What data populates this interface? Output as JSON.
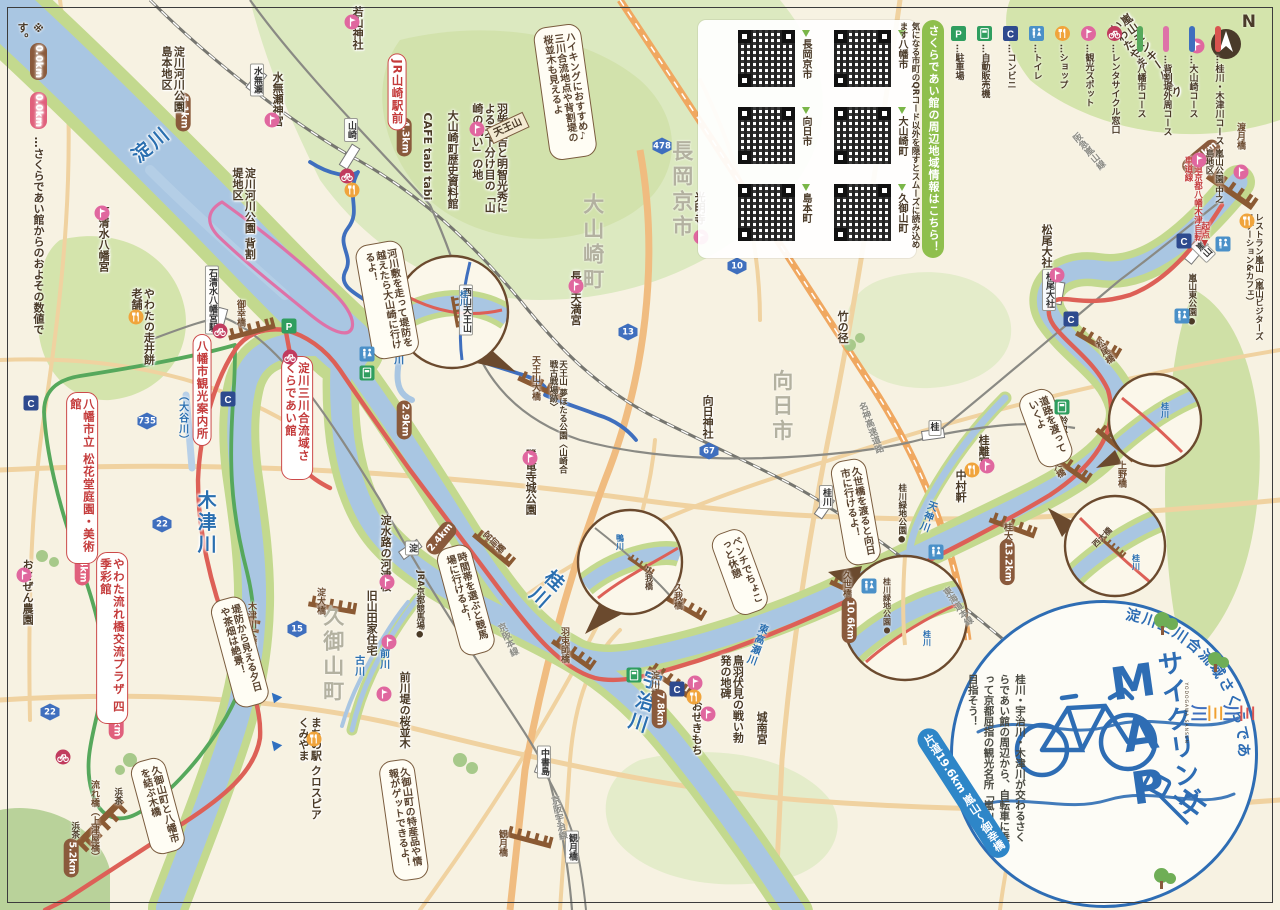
{
  "note": {
    "prefix": "※",
    "badge_brown": "0.0km",
    "badge_pink": "0.0km",
    "text": "…さくらであい館からのおよその数値です。"
  },
  "compass": {
    "n": "N"
  },
  "legend": {
    "items": [
      {
        "type": "parking",
        "label": "…駐車場"
      },
      {
        "type": "vending",
        "label": "…自動販売機"
      },
      {
        "type": "conbini",
        "label": "…コンビニ"
      },
      {
        "type": "toilet",
        "label": "…トイレ"
      },
      {
        "type": "shop",
        "label": "…ショップ"
      },
      {
        "type": "spot",
        "label": "…観光スポット"
      },
      {
        "type": "rental",
        "label": "…レンタサイクル窓口"
      },
      {
        "type": "course",
        "color": "#56a85c",
        "label": "…八幡市コース"
      },
      {
        "type": "course",
        "color": "#de72a8",
        "label": "…背割堤外周コース"
      },
      {
        "type": "course",
        "color": "#3f6fbe",
        "label": "…大山崎コース"
      },
      {
        "type": "course",
        "color": "#d9534f",
        "label": "…桂川・木津川コース"
      }
    ]
  },
  "qr_panel": {
    "banner": "さくらであい館の周辺地域情報はこちら！",
    "note": "気になる市町のQRコード以外を隠すとスムーズに読み込めます",
    "items": [
      "八幡市",
      "長岡京市",
      "大山崎町",
      "向日市",
      "久御山町",
      "島本町"
    ]
  },
  "stamp": {
    "arc": "淀川三川合流域さくらであい館",
    "title_kana": "サイクリング",
    "title_latin": "MAP",
    "desc": "桂川・宇治川・木津川が交わるさくらであい館の周辺から、自転車に乗って京都屈指の観光名所「嵐山」を目指そう！",
    "distance": "片道19.6km",
    "route": "嵐山〜御幸橋",
    "logo_chars": [
      {
        "ch": "三",
        "color": "#d9534f"
      },
      {
        "ch": "川",
        "color": "#3f6fbe"
      },
      {
        "ch": "三",
        "color": "#f0a030"
      },
      {
        "ch": "川",
        "color": "#3f6fbe"
      }
    ],
    "logo_caption": "YODOGAWA SANSEN"
  },
  "labels": [
    {
      "t": "淀川",
      "x": 152,
      "y": 145,
      "c": "riv",
      "r": -40,
      "n": "river-yodogawa"
    },
    {
      "t": "桂川",
      "x": 545,
      "y": 588,
      "c": "riv v",
      "r": 42,
      "n": "river-katsuragawa"
    },
    {
      "t": "木津川",
      "x": 205,
      "y": 523,
      "c": "riv v",
      "n": "river-kizugawa"
    },
    {
      "t": "宇治川",
      "x": 643,
      "y": 702,
      "c": "riv v",
      "r": 18,
      "n": "river-ujigawa"
    },
    {
      "t": "天神川",
      "x": 927,
      "y": 516,
      "c": "rivs v",
      "r": 20,
      "n": "river-tenjingawa"
    },
    {
      "t": "小泉川",
      "x": 397,
      "y": 349,
      "c": "rivs v",
      "n": "river-koizumigawa"
    },
    {
      "t": "前川",
      "x": 383,
      "y": 659,
      "c": "rivs v",
      "n": "river-maekawa"
    },
    {
      "t": "古川",
      "x": 358,
      "y": 666,
      "c": "rivs v",
      "n": "river-furukawa"
    },
    {
      "t": "（大谷川）",
      "x": 182,
      "y": 418,
      "c": "rivs v",
      "n": "river-otanigawa"
    },
    {
      "t": "東高瀬川",
      "x": 756,
      "y": 644,
      "c": "rivs v",
      "r": 20,
      "n": "river-higashitakase"
    },
    {
      "t": "八幡市",
      "x": 76,
      "y": 482,
      "c": "area v",
      "n": "area-yawata-city"
    },
    {
      "t": "久御山町",
      "x": 332,
      "y": 655,
      "c": "area v",
      "n": "area-kumiyama"
    },
    {
      "t": "大山崎町",
      "x": 592,
      "y": 243,
      "c": "area v",
      "n": "area-oyamazaki"
    },
    {
      "t": "長岡京市",
      "x": 681,
      "y": 190,
      "c": "area v",
      "n": "area-nagaokakyo"
    },
    {
      "t": "向日市",
      "x": 781,
      "y": 407,
      "c": "area v",
      "n": "area-muko"
    },
    {
      "t": "水無瀬",
      "x": 257,
      "y": 80,
      "c": "sta v",
      "n": "station-minase"
    },
    {
      "t": "山崎",
      "x": 351,
      "y": 130,
      "c": "sta v",
      "n": "station-yamazaki"
    },
    {
      "t": "石清水八幡宮駅",
      "x": 212,
      "y": 300,
      "c": "sta v",
      "n": "station-iwashimizu"
    },
    {
      "t": "淀",
      "x": 412,
      "y": 548,
      "c": "sta v",
      "n": "station-yodo"
    },
    {
      "t": "中書島",
      "x": 544,
      "y": 762,
      "c": "sta v",
      "n": "station-chushojima"
    },
    {
      "t": "観月橋",
      "x": 572,
      "y": 847,
      "c": "sta v",
      "n": "station-kangetsukyo"
    },
    {
      "t": "桂",
      "x": 935,
      "y": 428,
      "c": "sta",
      "n": "station-katsura"
    },
    {
      "t": "桂川",
      "x": 826,
      "y": 497,
      "c": "sta v",
      "n": "station-katsuragawa"
    },
    {
      "t": "嵐山",
      "x": 1203,
      "y": 250,
      "c": "sta v",
      "r": -45,
      "n": "station-arashiyama"
    },
    {
      "t": "松尾大社",
      "x": 1049,
      "y": 290,
      "c": "sta v",
      "n": "station-matsuo-taisha"
    },
    {
      "t": "西山天王山",
      "x": 466,
      "y": 310,
      "c": "sta v",
      "n": "station-nishiyama-tennozan"
    },
    {
      "t": "京阪本線",
      "x": 507,
      "y": 640,
      "c": "rail v",
      "r": -25,
      "n": "railline-keihan-main"
    },
    {
      "t": "京阪宇治線",
      "x": 558,
      "y": 818,
      "c": "rail v",
      "r": -12,
      "n": "railline-keihan-uji"
    },
    {
      "t": "東海道本線",
      "x": 957,
      "y": 607,
      "c": "rail v",
      "r": -35,
      "n": "railline-tokaido"
    },
    {
      "t": "阪急嵐山線",
      "x": 1088,
      "y": 152,
      "c": "rail v",
      "r": -40,
      "n": "railline-hankyu-arashiyama"
    },
    {
      "t": "名神高速道路",
      "x": 870,
      "y": 428,
      "c": "rail v",
      "r": -20,
      "n": "road-meishin"
    },
    {
      "t": "御幸橋",
      "x": 240,
      "y": 313,
      "c": "brg v",
      "n": "bridge-gokobashi"
    },
    {
      "t": "天王山大橋",
      "x": 535,
      "y": 378,
      "c": "brg v",
      "n": "bridge-tennozan"
    },
    {
      "t": "宮前橋",
      "x": 493,
      "y": 543,
      "c": "brg v",
      "r": -45,
      "n": "bridge-miyamae"
    },
    {
      "t": "羽束師橋",
      "x": 564,
      "y": 645,
      "c": "brg v",
      "n": "bridge-hazukashi"
    },
    {
      "t": "久我橋",
      "x": 677,
      "y": 596,
      "c": "brg v",
      "n": "bridge-kugabashi"
    },
    {
      "t": "久世橋",
      "x": 846,
      "y": 584,
      "c": "brg v",
      "n": "bridge-kuzebashi"
    },
    {
      "t": "桂大橋",
      "x": 1007,
      "y": 536,
      "c": "brg v",
      "n": "bridge-katsura-ohashi"
    },
    {
      "t": "西大橋",
      "x": 1055,
      "y": 466,
      "c": "brg v",
      "r": -30,
      "n": "bridge-nishi-ohashi"
    },
    {
      "t": "上野橋",
      "x": 1121,
      "y": 474,
      "c": "brg v",
      "n": "bridge-uenobashi"
    },
    {
      "t": "松尾橋",
      "x": 1104,
      "y": 352,
      "c": "brg v",
      "r": -30,
      "n": "bridge-matsuobashi"
    },
    {
      "t": "渡月橋",
      "x": 1240,
      "y": 136,
      "c": "brg v",
      "n": "bridge-togetsukyo"
    },
    {
      "t": "淀大橋",
      "x": 320,
      "y": 601,
      "c": "brg v",
      "n": "bridge-yodo-ohashi"
    },
    {
      "t": "木津川大橋",
      "x": 251,
      "y": 624,
      "c": "brg v",
      "n": "bridge-kizugawa-ohashi"
    },
    {
      "t": "淀川橋",
      "x": 654,
      "y": 684,
      "c": "brg v",
      "n": "bridge-yodogawabashi"
    },
    {
      "t": "観月橋",
      "x": 502,
      "y": 843,
      "c": "brg v",
      "n": "bridge-kangetsukyo"
    },
    {
      "t": "流れ橋（上津屋橋）",
      "x": 94,
      "y": 834,
      "c": "brg v",
      "h": 108,
      "n": "bridge-nagarebashi"
    },
    {
      "t": "19.6km",
      "x": 1201,
      "y": 157,
      "c": "bb",
      "r": -40,
      "n": "distance-togetsukyo"
    },
    {
      "t": "4.3km",
      "x": 404,
      "y": 137,
      "c": "bb v",
      "n": "distance-yamazaki"
    },
    {
      "t": "5.1km",
      "x": 183,
      "y": 112,
      "c": "bb v",
      "n": "distance-shimamoto"
    },
    {
      "t": "2.9km",
      "x": 404,
      "y": 420,
      "c": "bb v",
      "n": "distance-29"
    },
    {
      "t": "2.4km",
      "x": 441,
      "y": 538,
      "c": "bb",
      "r": -50,
      "n": "distance-miyamae"
    },
    {
      "t": "13.2km",
      "x": 1007,
      "y": 562,
      "c": "bb v",
      "n": "distance-katsura-ohashi"
    },
    {
      "t": "10.6km",
      "x": 849,
      "y": 620,
      "c": "bb v",
      "n": "distance-kuzebashi"
    },
    {
      "t": "7.8km",
      "x": 659,
      "y": 709,
      "c": "bb v",
      "n": "distance-yodogawabashi"
    },
    {
      "t": "5.2km",
      "x": 71,
      "y": 858,
      "c": "bb v",
      "n": "distance-nagarebashi"
    },
    {
      "t": "3.4km",
      "x": 82,
      "y": 566,
      "c": "bp v",
      "n": "distance-shokado"
    },
    {
      "t": "7.8km",
      "x": 116,
      "y": 720,
      "c": "bp v",
      "n": "distance-shikisaikan"
    },
    {
      "t": "JR山崎駅前",
      "x": 397,
      "y": 92,
      "c": "pill v",
      "n": "poi-jr-yamazaki-ekimae"
    },
    {
      "t": "八幡市観光案内所",
      "x": 202,
      "y": 390,
      "c": "pill v",
      "n": "poi-yawata-tourist-info"
    },
    {
      "t": "淀川三川合流域さくらであい館",
      "x": 297,
      "y": 418,
      "c": "pill v",
      "h": 112,
      "n": "poi-sakura-deaikan"
    },
    {
      "t": "八幡市立 松花堂庭園・美術館",
      "x": 82,
      "y": 478,
      "c": "pill v",
      "h": 160,
      "n": "poi-shokado-garden"
    },
    {
      "t": "やわた流れ橋交流プラザ 四季彩館",
      "x": 112,
      "y": 638,
      "c": "pill v",
      "h": 160,
      "n": "poi-shikisaikan"
    },
    {
      "t": "嵐山モンキーパーク いわたやま",
      "x": 1146,
      "y": 60,
      "c": "poi v",
      "h": 100,
      "r": -35,
      "n": "poi-monkey-park"
    },
    {
      "t": "嵐山公園 中之島地区",
      "x": 1213,
      "y": 180,
      "c": "pois v",
      "h": 62,
      "n": "poi-arashiyama-park"
    },
    {
      "t": "レストラン嵐山（嵐山ビジターズステーション&カフェ）",
      "x": 1253,
      "y": 278,
      "c": "pois v",
      "h": 130,
      "n": "poi-restaurant-arashiyama"
    },
    {
      "t": "嵐山東公園●",
      "x": 1191,
      "y": 300,
      "c": "pois v",
      "n": "poi-arashiyama-higashi-park"
    },
    {
      "t": "松尾大社",
      "x": 1046,
      "y": 246,
      "c": "poi v",
      "n": "poi-matsuo-taisha"
    },
    {
      "t": "●鈴虫寺",
      "x": 1062,
      "y": 424,
      "c": "pois v",
      "n": "poi-suzumushidera"
    },
    {
      "t": "桂離宮",
      "x": 983,
      "y": 451,
      "c": "poi v",
      "n": "poi-katsura-rikyu"
    },
    {
      "t": "中村軒",
      "x": 960,
      "y": 486,
      "c": "poi v",
      "n": "poi-nakamuraken"
    },
    {
      "t": "桂川緑地公園●",
      "x": 901,
      "y": 514,
      "c": "pois v",
      "n": "poi-katsuragawa-ryokuchi"
    },
    {
      "t": "竹の径",
      "x": 842,
      "y": 327,
      "c": "poi v",
      "n": "poi-takenomichi"
    },
    {
      "t": "向日神社",
      "x": 707,
      "y": 417,
      "c": "poi v",
      "n": "poi-muko-jinja"
    },
    {
      "t": "長岡天満宮",
      "x": 575,
      "y": 298,
      "c": "poi v",
      "n": "poi-nagaoka-tenmangu"
    },
    {
      "t": "光明寺",
      "x": 699,
      "y": 208,
      "c": "poi v",
      "n": "poi-komyoji"
    },
    {
      "t": "勝竜寺城公園",
      "x": 530,
      "y": 482,
      "c": "poi v",
      "n": "poi-shoryuji-castle-park"
    },
    {
      "t": "天王山 夢ほたる公園〈山崎合戦古戦場跡〉",
      "x": 557,
      "y": 420,
      "c": "pois v",
      "h": 120,
      "n": "poi-yumehotaru-park"
    },
    {
      "t": "大山崎町歴史資料館",
      "x": 452,
      "y": 170,
      "c": "poi v",
      "h": 120,
      "n": "poi-oyamazaki-museum"
    },
    {
      "t": "CAFE tabi tabi",
      "x": 427,
      "y": 160,
      "c": "poi v",
      "h": 95,
      "n": "poi-cafe-tabitabi"
    },
    {
      "t": "羽柴秀吉と明智光秀による天下分け目の「山崎の戦い」の地",
      "x": 489,
      "y": 158,
      "c": "poi v",
      "h": 110,
      "n": "poi-yamazaki-battle-site"
    },
    {
      "t": "天王山",
      "x": 508,
      "y": 128,
      "c": "sign",
      "r": -25,
      "n": "poi-tennozan-sign"
    },
    {
      "t": "若山神社",
      "x": 357,
      "y": 36,
      "c": "poi v",
      "h": 60,
      "n": "poi-wakayama-jinja"
    },
    {
      "t": "水無瀬神宮",
      "x": 277,
      "y": 99,
      "c": "poi v",
      "n": "poi-minase-jingu"
    },
    {
      "t": "淀川河川公園 背割堤地区",
      "x": 243,
      "y": 215,
      "c": "poi v",
      "h": 95,
      "n": "poi-sewaritei-area"
    },
    {
      "t": "淀川河川公園 島本地区",
      "x": 172,
      "y": 86,
      "c": "poi v",
      "h": 80,
      "n": "poi-shimamoto-area"
    },
    {
      "t": "石清水八幡宮",
      "x": 103,
      "y": 239,
      "c": "poi v",
      "n": "poi-iwashimizu-hachimangu"
    },
    {
      "t": "やわたの走井餅老舗",
      "x": 142,
      "y": 328,
      "c": "poi v",
      "h": 80,
      "n": "poi-hashiirimochi"
    },
    {
      "t": "おさぜん農園",
      "x": 27,
      "y": 592,
      "c": "poi v",
      "n": "poi-osazen-farm"
    },
    {
      "t": "浜茶",
      "x": 117,
      "y": 796,
      "c": "pois v",
      "n": "poi-hamacha-1"
    },
    {
      "t": "浜茶",
      "x": 74,
      "y": 830,
      "c": "pois v",
      "n": "poi-hamacha-2"
    },
    {
      "t": "JRA京都競馬場●",
      "x": 419,
      "y": 605,
      "c": "pois v",
      "n": "poi-kyoto-racecourse"
    },
    {
      "t": "淀水路の河津桜",
      "x": 385,
      "y": 553,
      "c": "poi v",
      "n": "poi-yodo-suiro-sakura"
    },
    {
      "t": "旧山田家住宅",
      "x": 371,
      "y": 623,
      "c": "poi v",
      "n": "poi-yamada-house"
    },
    {
      "t": "前川堤の桜並木",
      "x": 404,
      "y": 710,
      "c": "poi v",
      "n": "poi-maekawa-sakura"
    },
    {
      "t": "まちの駅 クロスピアくみやま",
      "x": 309,
      "y": 772,
      "c": "poi v",
      "h": 110,
      "n": "poi-crosspia-kumiyama"
    },
    {
      "t": "鳥羽伏見の戦い勃発の地碑",
      "x": 731,
      "y": 700,
      "c": "poi v",
      "h": 90,
      "n": "poi-toba-fushimi-monument"
    },
    {
      "t": "城南宮",
      "x": 761,
      "y": 728,
      "c": "poi v",
      "n": "poi-jonangu"
    },
    {
      "t": "おせきもち",
      "x": 696,
      "y": 728,
      "c": "poi v",
      "n": "poi-osekimochi"
    },
    {
      "t": "府道京都八幡木津自転車道線",
      "x": 1192,
      "y": 202,
      "c": "reds v",
      "h": 92,
      "n": "label-cycling-road"
    },
    {
      "t": "起点▼",
      "x": 1204,
      "y": 235,
      "c": "reds v",
      "n": "label-kiten"
    },
    {
      "t": "ハイキングにおすすめ♪ 三川合流地点や背割堤の桜並木も見えるよ",
      "x": 565,
      "y": 92,
      "c": "bub v",
      "h": 118,
      "r": -8,
      "n": "bubble-hiking"
    },
    {
      "t": "河川敷を走って堤防を越えたら大山崎に行けるよ！",
      "x": 387,
      "y": 300,
      "c": "bub v",
      "h": 100,
      "r": -10,
      "n": "bubble-kasenjiki"
    },
    {
      "t": "時間帯を選ぶと競馬場に行けるよ！",
      "x": 466,
      "y": 600,
      "c": "bub v",
      "h": 95,
      "r": -15,
      "n": "bubble-racecourse"
    },
    {
      "t": "ベンチでちょこっと休憩",
      "x": 740,
      "y": 572,
      "c": "bub v",
      "h": 70,
      "r": -20,
      "n": "bubble-bench"
    },
    {
      "t": "久世橋を渡ると向日市に行けるよ！",
      "x": 856,
      "y": 512,
      "c": "bub v",
      "h": 90,
      "r": -10,
      "n": "bubble-kuzebashi"
    },
    {
      "t": "堤防から見える夕日や茶畑は絶景！",
      "x": 240,
      "y": 652,
      "c": "bub v",
      "h": 95,
      "r": -15,
      "n": "bubble-chabatake"
    },
    {
      "t": "久御山町と八幡市を結ぶ木橋",
      "x": 158,
      "y": 806,
      "c": "bub v",
      "h": 80,
      "r": -15,
      "n": "bubble-wooden-bridge"
    },
    {
      "t": "久御山町の特産品や情報がゲットできるよ！",
      "x": 404,
      "y": 820,
      "c": "bub v",
      "h": 105,
      "r": -8,
      "n": "bubble-kumiyama-info"
    },
    {
      "t": "道路を渡っていくよ",
      "x": 1046,
      "y": 428,
      "c": "bub v",
      "h": 62,
      "r": -20,
      "n": "bubble-cross-road"
    },
    {
      "t": "桂川",
      "x": 463,
      "y": 298,
      "c": "ins v",
      "n": "inset-a-katsuragawa"
    },
    {
      "t": "鴨川",
      "x": 619,
      "y": 542,
      "c": "ins v",
      "n": "inset-b-kamogawa"
    },
    {
      "t": "久我橋",
      "x": 648,
      "y": 578,
      "c": "insb v",
      "n": "inset-b-kugabashi"
    },
    {
      "t": "桂川緑地公園●",
      "x": 886,
      "y": 606,
      "c": "insb v",
      "n": "inset-c-ryokuchi"
    },
    {
      "t": "桂川",
      "x": 926,
      "y": 638,
      "c": "ins v",
      "n": "inset-c-katsuragawa"
    },
    {
      "t": "桂川",
      "x": 1164,
      "y": 410,
      "c": "ins v",
      "n": "inset-d-katsuragawa"
    },
    {
      "t": "西大橋",
      "x": 1103,
      "y": 538,
      "c": "insb",
      "r": -45,
      "n": "inset-e-nishiohashi"
    },
    {
      "t": "桂川",
      "x": 1135,
      "y": 562,
      "c": "ins v",
      "n": "inset-e-katsuragawa"
    }
  ],
  "shields": [
    {
      "no": "478",
      "x": 662,
      "y": 146
    },
    {
      "no": "10",
      "x": 737,
      "y": 266
    },
    {
      "no": "13",
      "x": 628,
      "y": 332
    },
    {
      "no": "67",
      "x": 709,
      "y": 451
    },
    {
      "no": "735",
      "x": 147,
      "y": 421
    },
    {
      "no": "22",
      "x": 162,
      "y": 524
    },
    {
      "no": "22",
      "x": 50,
      "y": 712
    },
    {
      "no": "15",
      "x": 297,
      "y": 629
    }
  ],
  "markers": [
    {
      "k": "rental",
      "x": 290,
      "y": 357
    },
    {
      "k": "rental",
      "x": 220,
      "y": 331
    },
    {
      "k": "rental",
      "x": 347,
      "y": 176
    },
    {
      "k": "rental",
      "x": 63,
      "y": 757
    },
    {
      "k": "spot",
      "x": 352,
      "y": 22
    },
    {
      "k": "spot",
      "x": 272,
      "y": 120
    },
    {
      "k": "spot",
      "x": 102,
      "y": 213
    },
    {
      "k": "spot",
      "x": 477,
      "y": 129
    },
    {
      "k": "spot",
      "x": 701,
      "y": 237
    },
    {
      "k": "spot",
      "x": 576,
      "y": 286
    },
    {
      "k": "spot",
      "x": 530,
      "y": 458
    },
    {
      "k": "spot",
      "x": 1057,
      "y": 275
    },
    {
      "k": "spot",
      "x": 987,
      "y": 466
    },
    {
      "k": "spot",
      "x": 387,
      "y": 582
    },
    {
      "k": "spot",
      "x": 389,
      "y": 642
    },
    {
      "k": "spot",
      "x": 384,
      "y": 694
    },
    {
      "k": "spot",
      "x": 695,
      "y": 683
    },
    {
      "k": "spot",
      "x": 708,
      "y": 714
    },
    {
      "k": "spot",
      "x": 1199,
      "y": 160
    },
    {
      "k": "spot",
      "x": 1241,
      "y": 172
    },
    {
      "k": "spot",
      "x": 1197,
      "y": 46
    },
    {
      "k": "spot",
      "x": 24,
      "y": 575
    },
    {
      "k": "shop",
      "x": 136,
      "y": 317
    },
    {
      "k": "shop",
      "x": 352,
      "y": 190
    },
    {
      "k": "shop",
      "x": 972,
      "y": 470
    },
    {
      "k": "shop",
      "x": 694,
      "y": 697
    },
    {
      "k": "shop",
      "x": 314,
      "y": 739
    },
    {
      "k": "shop",
      "x": 1247,
      "y": 221
    },
    {
      "k": "toilet",
      "x": 367,
      "y": 354
    },
    {
      "k": "toilet",
      "x": 936,
      "y": 552
    },
    {
      "k": "toilet",
      "x": 869,
      "y": 586
    },
    {
      "k": "toilet",
      "x": 1223,
      "y": 244
    },
    {
      "k": "toilet",
      "x": 1182,
      "y": 316
    },
    {
      "k": "conbini",
      "x": 31,
      "y": 403
    },
    {
      "k": "conbini",
      "x": 228,
      "y": 399
    },
    {
      "k": "conbini",
      "x": 677,
      "y": 689
    },
    {
      "k": "conbini",
      "x": 1071,
      "y": 319
    },
    {
      "k": "conbini",
      "x": 1184,
      "y": 241
    },
    {
      "k": "vending",
      "x": 367,
      "y": 373
    },
    {
      "k": "vending",
      "x": 1062,
      "y": 407
    },
    {
      "k": "vending",
      "x": 634,
      "y": 675
    },
    {
      "k": "parking",
      "x": 289,
      "y": 326
    },
    {
      "k": "flow",
      "x": 277,
      "y": 698
    },
    {
      "k": "flow",
      "x": 277,
      "y": 746
    }
  ]
}
